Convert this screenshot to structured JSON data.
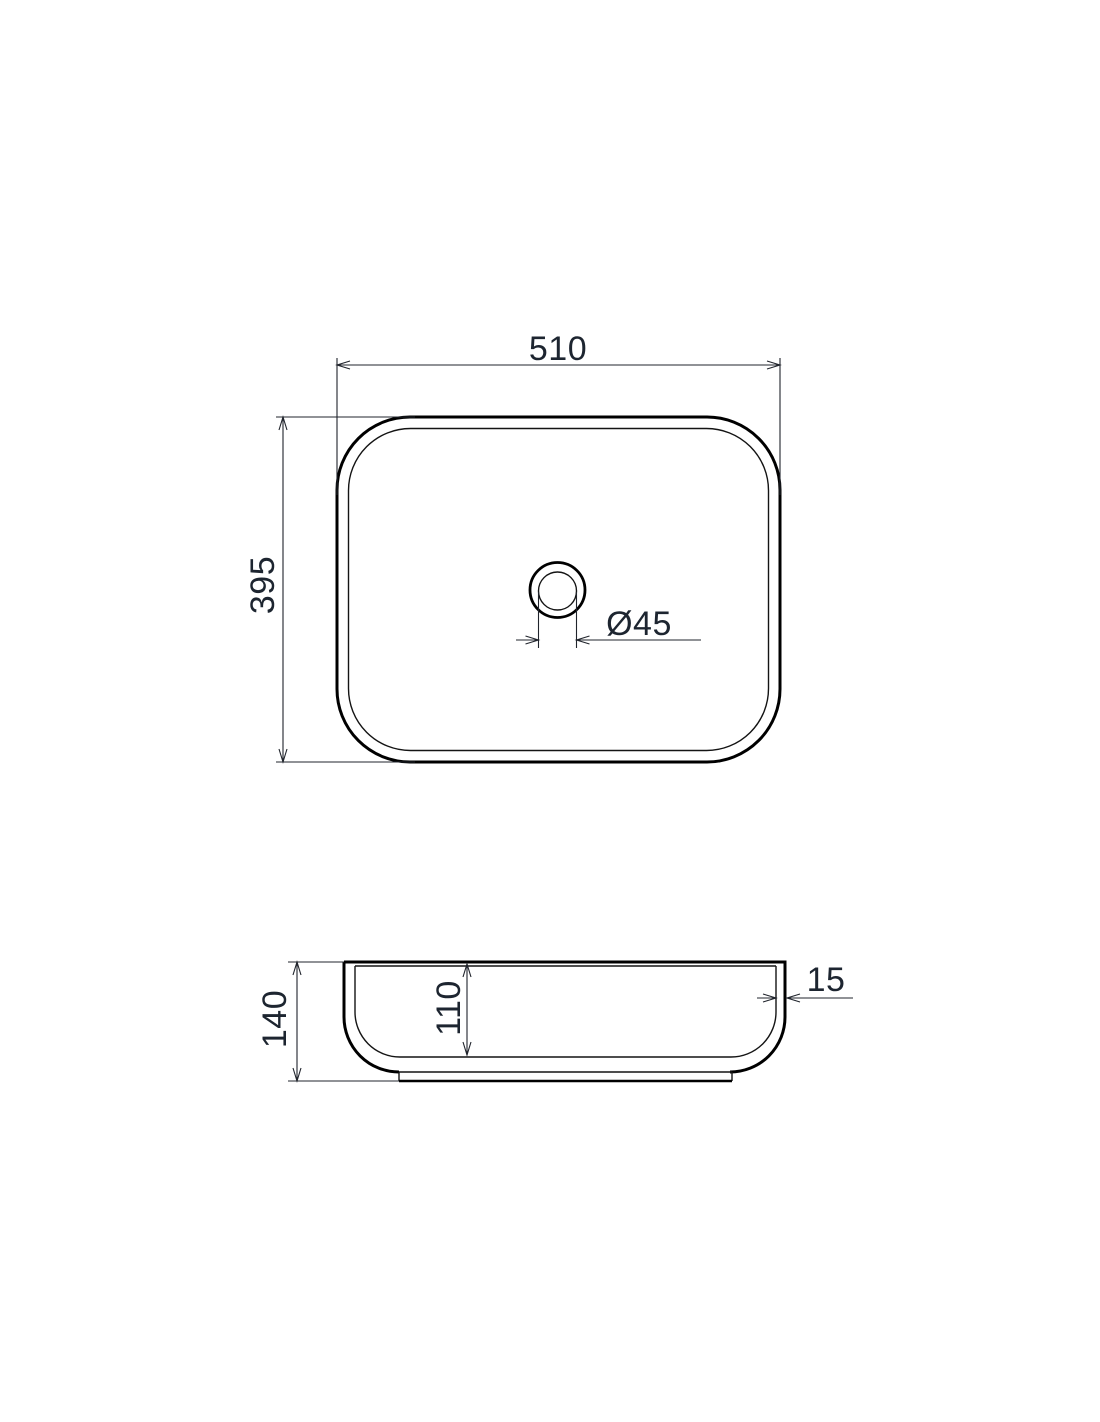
{
  "drawing": {
    "type": "washbasin-dimension-drawing",
    "top_view": {
      "width_label": "510",
      "depth_label": "395",
      "drain_diameter_label": "Ø45"
    },
    "side_view": {
      "height_label": "140",
      "basin_depth_label": "110",
      "rim_thickness_label": "15"
    },
    "colors": {
      "line": "#000000",
      "dimension_line": "#20242c",
      "text": "#1d2530",
      "background": "#ffffff"
    }
  }
}
